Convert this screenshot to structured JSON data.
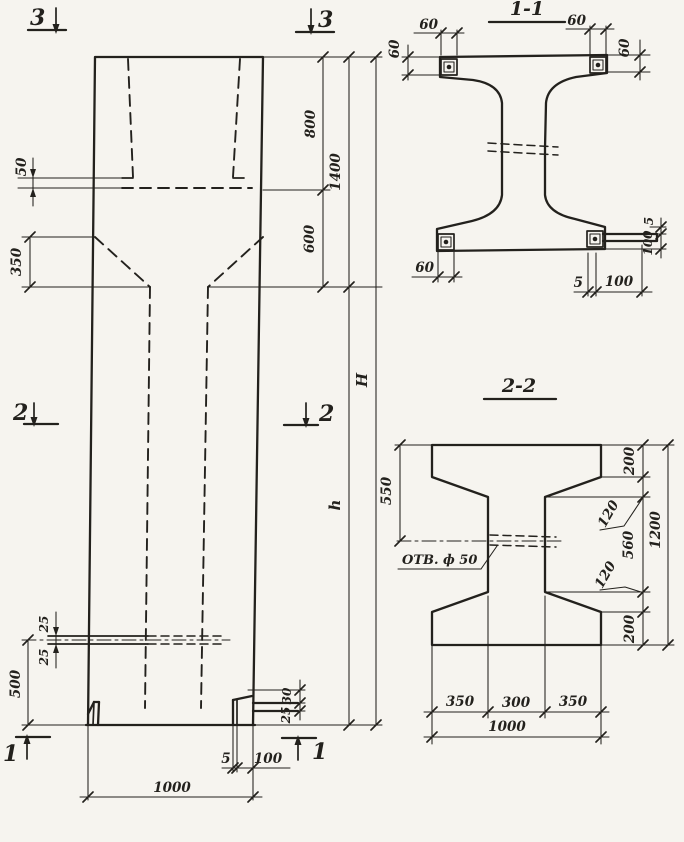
{
  "colors": {
    "paper": "#f6f4ef",
    "ink": "#23211d"
  },
  "elevation": {
    "markers": {
      "top_left": "3",
      "top_right": "3",
      "mid_left": "2",
      "mid_right": "2",
      "bottom_left": "1",
      "bottom_right": "1"
    },
    "dims": {
      "ledge_offset": "50",
      "taper_height": "350",
      "upper_segment": "800",
      "upper_total": "1400",
      "neck_height": "600",
      "overall_height": "H",
      "shaft_height": "h",
      "slot_upper": "25",
      "slot_lower": "25",
      "hole_elevation": "500",
      "base_plate_rise": "30",
      "base_plate_thk": "25",
      "base_plate_gap": "5",
      "base_plate_len": "100",
      "column_width": "1000"
    }
  },
  "section_1_1": {
    "title": "1-1",
    "dims": {
      "top_left_width": "60",
      "top_left_depth": "60",
      "top_right_width": "60",
      "top_right_depth": "60",
      "bottom_left_width": "60",
      "bottom_gap": "5",
      "bottom_length": "100",
      "right_gap": "5",
      "right_length": "100"
    }
  },
  "section_2_2": {
    "title": "2-2",
    "hole_note": "ОТВ. ф 50",
    "dims": {
      "top_to_hole": "550",
      "flange_top": "200",
      "haunch_top": "120",
      "web_height": "560",
      "haunch_bottom": "120",
      "flange_bottom": "200",
      "total_height": "1200",
      "bottom_left": "350",
      "bottom_middle": "300",
      "bottom_right": "350",
      "total_width": "1000"
    }
  }
}
